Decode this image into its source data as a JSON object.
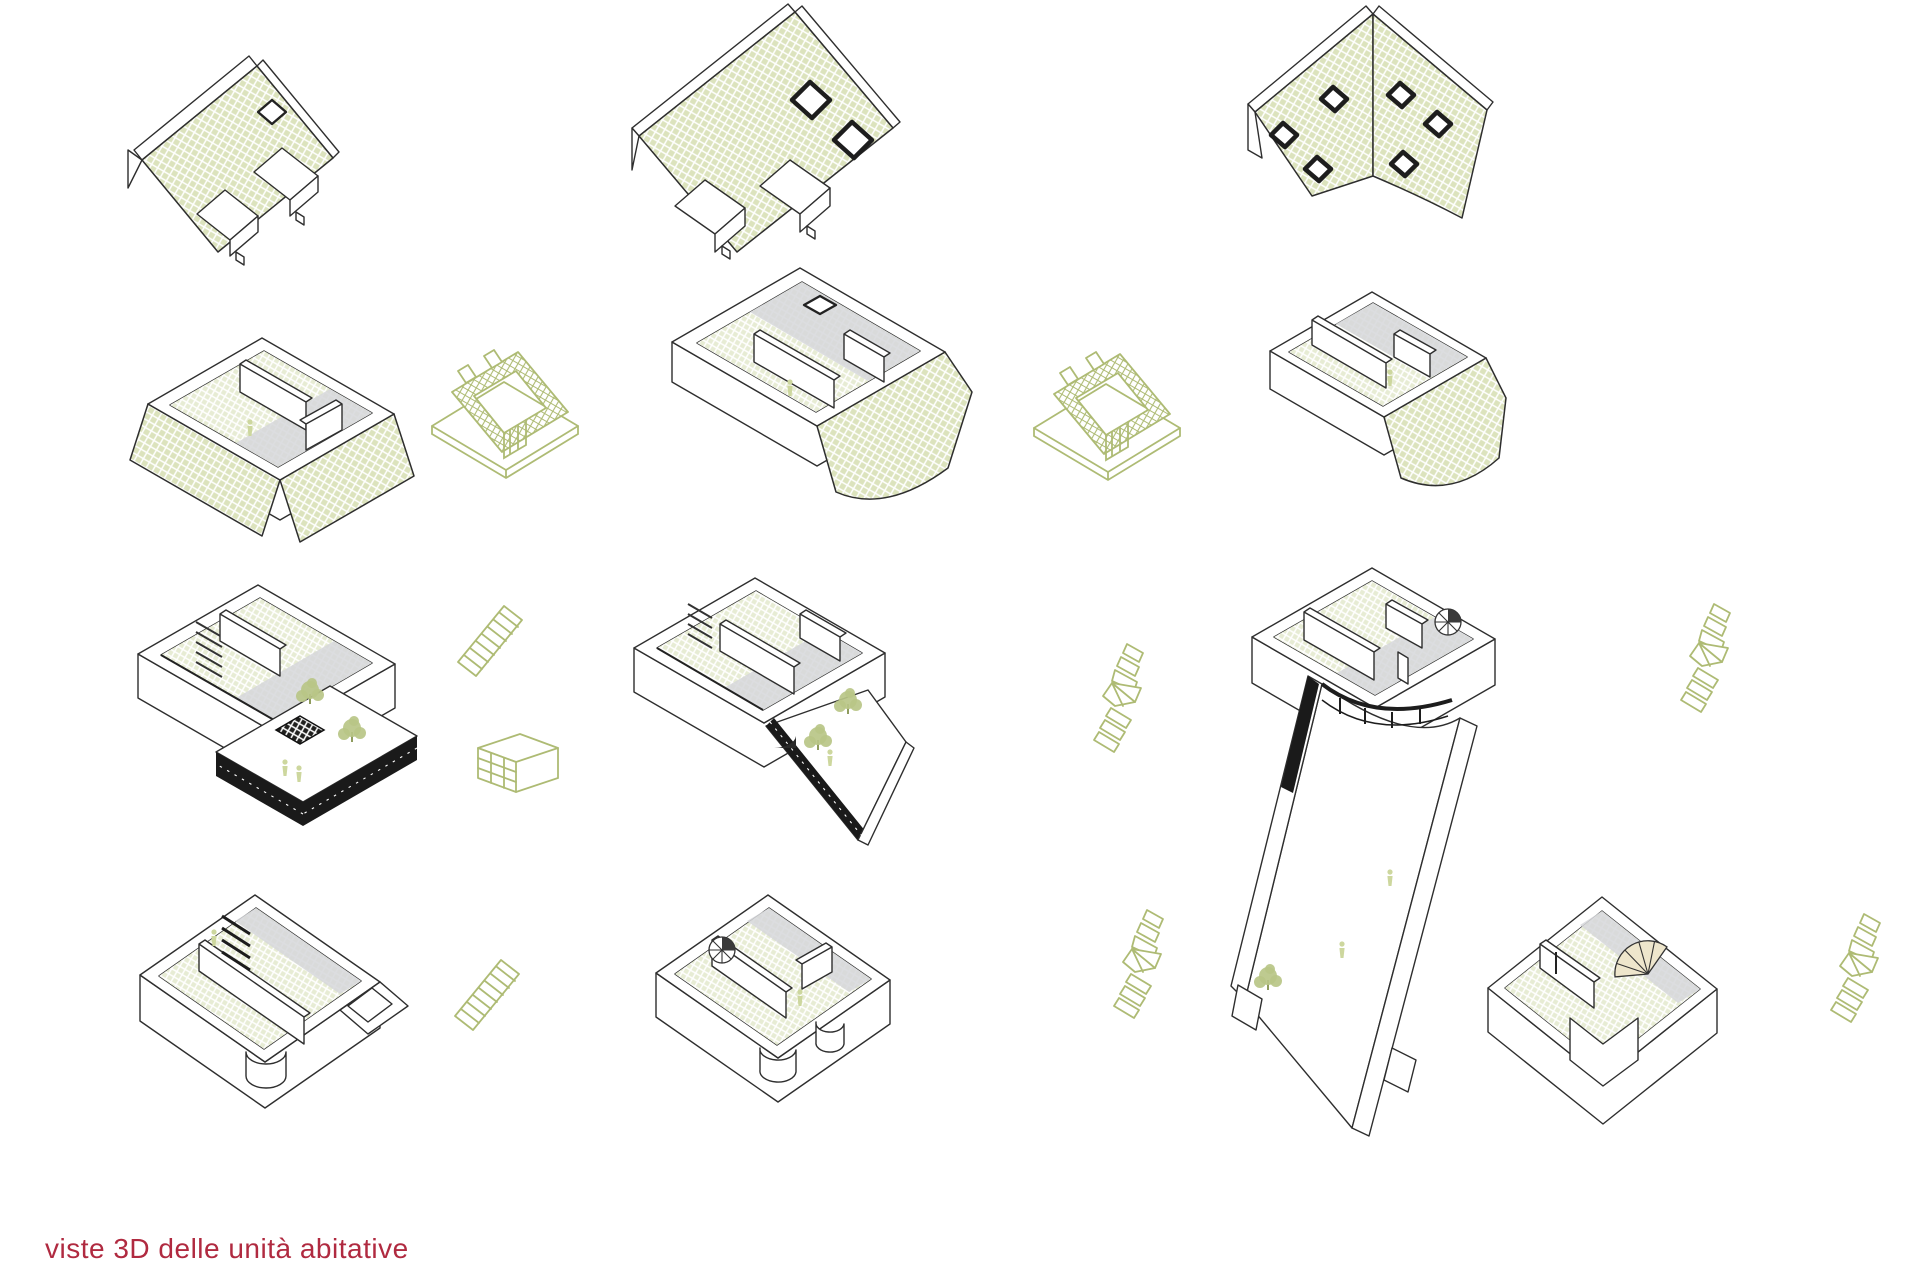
{
  "caption": {
    "text": "viste 3D delle unità abitative"
  },
  "colors": {
    "page_bg": "#ffffff",
    "roof_hatch": "#dce3bd",
    "floor_hatch": "#e7ecd4",
    "accent_green": "#aebb74",
    "terrace_green": "#d6ddb0",
    "tree_green": "#b9c587",
    "figure_green": "#cdd79e",
    "line_dark": "#2e2e2e",
    "gray_wall": "#c9cacd",
    "gray_light": "#d6d7da",
    "railing_dark": "#1a1a1a",
    "caption_red": "#b02a40"
  },
  "figures": [
    {
      "name": "unit-a-roof-axon",
      "kind": "roof-view",
      "row": 1,
      "col": 1,
      "features": "pitched roof with green tile hatch, one skylight, two grey dormers"
    },
    {
      "name": "unit-b-roof-axon",
      "kind": "roof-view",
      "row": 1,
      "col": 2,
      "features": "large pitched roof, two dark-framed skylights, two grey dormers"
    },
    {
      "name": "unit-c-roof-axon",
      "kind": "roof-view",
      "row": 1,
      "col": 3,
      "features": "folded two-plane roof with curved eave and six skylights"
    },
    {
      "name": "unit-a-attic-axon",
      "kind": "floor-view",
      "row": 2,
      "col": 1,
      "features": "attic floor plan with partial hatched roof planes"
    },
    {
      "name": "dormer-detail-a",
      "kind": "green-line-detail",
      "row": 2,
      "features": "dormer construction detail in green linework"
    },
    {
      "name": "unit-b-attic-axon",
      "kind": "floor-view",
      "row": 2,
      "col": 2,
      "features": "attic floor plan with curved hatched roof wing"
    },
    {
      "name": "dormer-detail-b",
      "kind": "green-line-detail",
      "row": 2,
      "features": "dormer construction detail in green linework"
    },
    {
      "name": "unit-c-attic-axon",
      "kind": "floor-view",
      "row": 2,
      "col": 3,
      "features": "attic floor plan with curved hatched roof piece"
    },
    {
      "name": "unit-a-living-axon",
      "kind": "floor-view",
      "row": 3,
      "col": 1,
      "features": "living floor with terrace, dark railing, skylight grid, trees and figures"
    },
    {
      "name": "straight-stair-detail-a",
      "kind": "green-line-detail",
      "row": 3,
      "features": "straight stair detail"
    },
    {
      "name": "shelf-detail",
      "kind": "green-line-detail",
      "row": 3,
      "features": "shelving unit detail"
    },
    {
      "name": "unit-b-living-axon",
      "kind": "floor-view",
      "row": 3,
      "col": 2,
      "features": "living floor with pointed terrace, dark railing and trees"
    },
    {
      "name": "winder-stair-detail-a",
      "kind": "green-line-detail",
      "row": 3,
      "features": "winder stair detail"
    },
    {
      "name": "unit-c-living-axon",
      "kind": "floor-view",
      "row": 3,
      "col": 3,
      "features": "living floor with spiral stair, curved glazing and long tapering courtyard garden"
    },
    {
      "name": "winder-stair-detail-b",
      "kind": "green-line-detail",
      "row": 3,
      "features": "winder stair detail"
    },
    {
      "name": "unit-a-ground-axon",
      "kind": "floor-view",
      "row": 4,
      "col": 1,
      "features": "lower floor, two hatched rooms, dark stair, curved bay"
    },
    {
      "name": "straight-stair-detail-b",
      "kind": "green-line-detail",
      "row": 4,
      "features": "straight stair detail"
    },
    {
      "name": "unit-b-ground-axon",
      "kind": "floor-view",
      "row": 4,
      "col": 2,
      "features": "lower floor with spiral stair and two curved bays"
    },
    {
      "name": "winder-stair-detail-c",
      "kind": "green-line-detail",
      "row": 4,
      "features": "winder stair detail"
    },
    {
      "name": "unit-right-ground-axon",
      "kind": "floor-view",
      "row": 4,
      "col": 4,
      "features": "L-shaped lower floor with fan stair and hatched rooms"
    },
    {
      "name": "winder-stair-detail-d",
      "kind": "green-line-detail",
      "row": 4,
      "features": "winder stair detail"
    }
  ]
}
